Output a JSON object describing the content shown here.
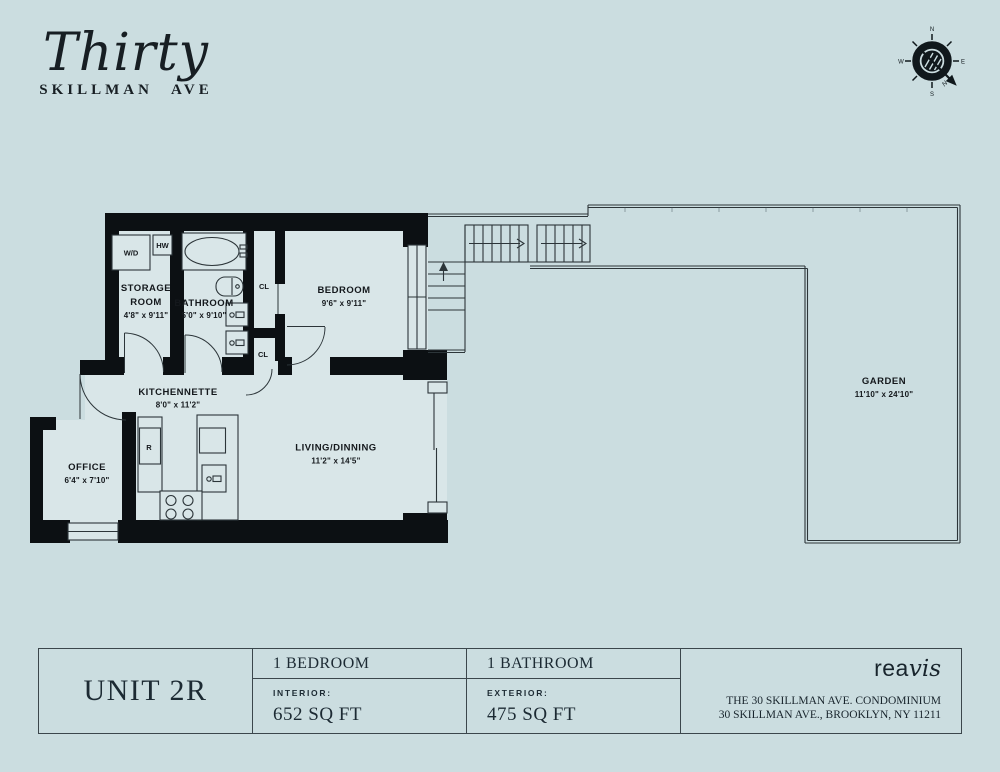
{
  "header": {
    "script": "Thirty",
    "sub_left": "SKILLMAN",
    "sub_right": "AVE"
  },
  "compass": {
    "n": "N",
    "e": "E",
    "s": "S",
    "w": "W",
    "arrow": "N"
  },
  "plan": {
    "rooms": {
      "storage": {
        "line1": "STORAGE",
        "line2": "ROOM",
        "dims": "4'8\" x 9'11\""
      },
      "bathroom": {
        "name": "BATHROOM",
        "dims": "5'0\" x 9'10\""
      },
      "bedroom": {
        "name": "BEDROOM",
        "dims": "9'6\" x 9'11\""
      },
      "kitchennette": {
        "name": "KITCHENNETTE",
        "dims": "8'0\" x 11'2\""
      },
      "living": {
        "name": "LIVING/DINNING",
        "dims": "11'2\" x 14'5\""
      },
      "office": {
        "name": "OFFICE",
        "dims": "6'4\" x 7'10\""
      },
      "garden": {
        "name": "GARDEN",
        "dims": "11'10\" x 24'10\""
      }
    },
    "fixtures": {
      "wd": "W/D",
      "hw": "HW",
      "r": "R",
      "cl_upper": "CL",
      "cl_lower": "CL"
    }
  },
  "footer": {
    "unit": "UNIT 2R",
    "bedroom_col": {
      "top": "1 BEDROOM",
      "label": "INTERIOR:",
      "value": "652 SQ FT"
    },
    "bathroom_col": {
      "top": "1 BATHROOM",
      "label": "EXTERIOR:",
      "value": "475 SQ FT"
    },
    "brand": {
      "rea": "rea",
      "vis": "vis"
    },
    "address1": "THE 30 SKILLMAN AVE. CONDOMINIUM",
    "address2": "30 SKILLMAN AVE., BROOKLYN, NY 11211"
  },
  "colors": {
    "background": "#cbdde0",
    "wall": "#0c1013",
    "floor": "#d9e6e8",
    "line": "#2c3539"
  }
}
